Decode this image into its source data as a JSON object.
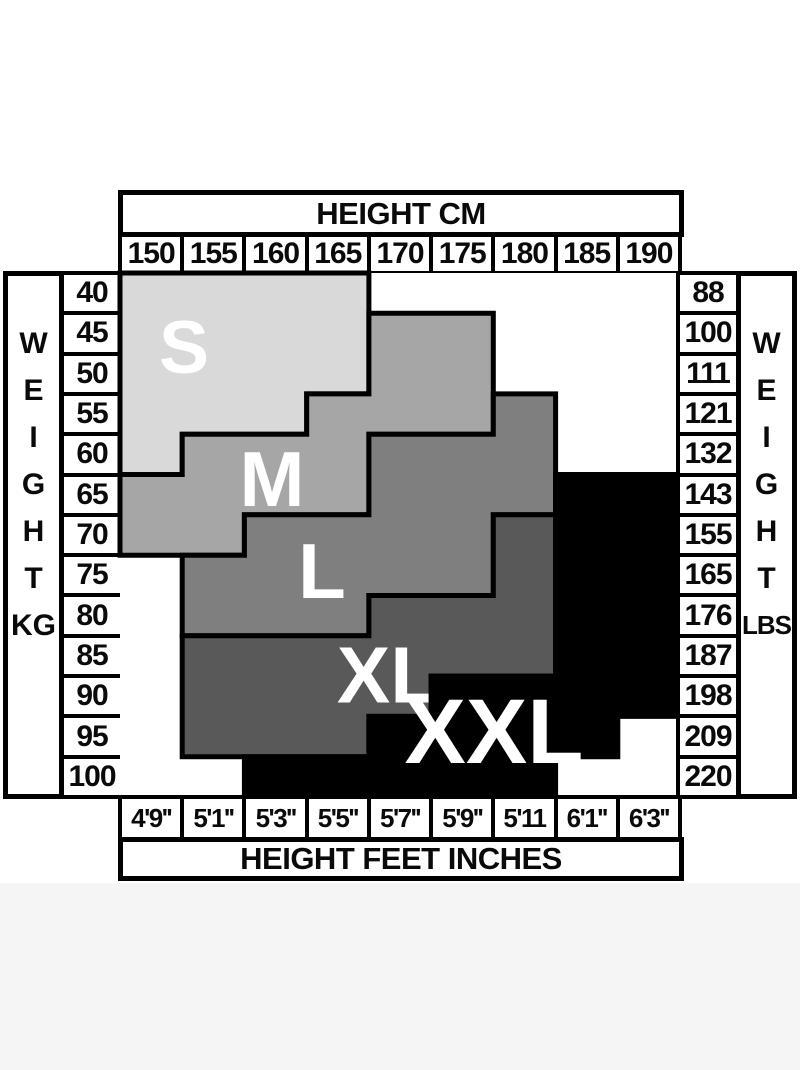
{
  "top_header": {
    "title": "HEIGHT CM"
  },
  "bottom_header": {
    "title": "HEIGHT FEET INCHES"
  },
  "left_axis": {
    "letters": [
      "W",
      "E",
      "I",
      "G",
      "H",
      "T"
    ],
    "unit": "KG"
  },
  "right_axis": {
    "letters": [
      "W",
      "E",
      "I",
      "G",
      "H",
      "T"
    ],
    "unit": "LBS"
  },
  "height_cm_values": [
    "150",
    "155",
    "160",
    "165",
    "170",
    "175",
    "180",
    "185",
    "190"
  ],
  "height_ft_values": [
    "4'9''",
    "5'1''",
    "5'3''",
    "5'5''",
    "5'7''",
    "5'9''",
    "5'11",
    "6'1''",
    "6'3''"
  ],
  "weight_kg_values": [
    "40",
    "45",
    "50",
    "55",
    "60",
    "65",
    "70",
    "75",
    "80",
    "85",
    "90",
    "95",
    "100"
  ],
  "weight_lbs_values": [
    "88",
    "100",
    "111",
    "121",
    "132",
    "143",
    "155",
    "165",
    "176",
    "187",
    "198",
    "209",
    "220"
  ],
  "border_color": "#000000",
  "label_color": "#ffffff",
  "sizes": [
    {
      "label": "S",
      "color": "#d9d9d9",
      "font_size": 75,
      "label_x": 64,
      "label_y": 74,
      "columns": [
        [
          0,
          0,
          4
        ],
        [
          1,
          0,
          3
        ],
        [
          2,
          0,
          3
        ],
        [
          3,
          0,
          2
        ]
      ]
    },
    {
      "label": "M",
      "color": "#a6a6a6",
      "font_size": 78,
      "label_x": 152,
      "label_y": 206,
      "columns": [
        [
          0,
          5,
          6
        ],
        [
          1,
          4,
          6
        ],
        [
          2,
          4,
          5
        ],
        [
          3,
          3,
          5
        ],
        [
          4,
          1,
          3
        ],
        [
          5,
          1,
          3
        ]
      ]
    },
    {
      "label": "L",
      "color": "#7f7f7f",
      "font_size": 78,
      "label_x": 202,
      "label_y": 298,
      "columns": [
        [
          1,
          7,
          8
        ],
        [
          2,
          6,
          8
        ],
        [
          3,
          6,
          8
        ],
        [
          4,
          4,
          7
        ],
        [
          5,
          4,
          7
        ],
        [
          6,
          3,
          5
        ]
      ]
    },
    {
      "label": "XL",
      "color": "#595959",
      "font_size": 80,
      "label_x": 268,
      "label_y": 402,
      "columns": [
        [
          1,
          9,
          11
        ],
        [
          2,
          9,
          11
        ],
        [
          3,
          9,
          11
        ],
        [
          4,
          8,
          10
        ],
        [
          5,
          8,
          9
        ],
        [
          6,
          6,
          9
        ]
      ]
    },
    {
      "label": "XXL",
      "color": "#000000",
      "font_size": 92,
      "label_x": 374,
      "label_y": 459,
      "columns": [
        [
          2,
          12,
          12
        ],
        [
          3,
          12,
          12
        ],
        [
          4,
          11,
          12
        ],
        [
          5,
          10,
          12
        ],
        [
          6,
          10,
          12
        ],
        [
          7,
          5,
          11
        ],
        [
          8,
          5,
          10
        ]
      ]
    }
  ],
  "chart_data": {
    "type": "heatmap",
    "x_top_label": "HEIGHT CM",
    "x_bottom_label": "HEIGHT FEET INCHES",
    "x_ticks_cm": [
      150,
      155,
      160,
      165,
      170,
      175,
      180,
      185,
      190
    ],
    "x_ticks_ft": [
      "4'9''",
      "5'1''",
      "5'3''",
      "5'5''",
      "5'7''",
      "5'9''",
      "5'11",
      "6'1''",
      "6'3''"
    ],
    "y_left_label": "WEIGHT KG",
    "y_right_label": "WEIGHT LBS",
    "y_ticks_kg": [
      40,
      45,
      50,
      55,
      60,
      65,
      70,
      75,
      80,
      85,
      90,
      95,
      100
    ],
    "y_ticks_lbs": [
      88,
      100,
      111,
      121,
      132,
      143,
      155,
      165,
      176,
      187,
      198,
      209,
      220
    ],
    "legend": [
      "S",
      "M",
      "L",
      "XL",
      "XXL"
    ],
    "size_colors": {
      "S": "#d9d9d9",
      "M": "#a6a6a6",
      "L": "#7f7f7f",
      "XL": "#595959",
      "XXL": "#000000"
    },
    "matrix_rows_weight_kg": [
      40,
      45,
      50,
      55,
      60,
      65,
      70,
      75,
      80,
      85,
      90,
      95,
      100
    ],
    "matrix_cols_height_cm": [
      150,
      155,
      160,
      165,
      170,
      175,
      180,
      185,
      190
    ],
    "matrix": [
      [
        "S",
        "S",
        "S",
        "S",
        "",
        "",
        "",
        "",
        ""
      ],
      [
        "S",
        "S",
        "S",
        "S",
        "M",
        "M",
        "",
        "",
        ""
      ],
      [
        "S",
        "S",
        "S",
        "S",
        "M",
        "M",
        "",
        "",
        ""
      ],
      [
        "S",
        "S",
        "S",
        "M",
        "M",
        "M",
        "L",
        "",
        ""
      ],
      [
        "S",
        "M",
        "M",
        "M",
        "L",
        "L",
        "L",
        "",
        ""
      ],
      [
        "M",
        "M",
        "M",
        "M",
        "L",
        "L",
        "L",
        "XXL",
        "XXL"
      ],
      [
        "M",
        "M",
        "L",
        "L",
        "L",
        "L",
        "XL",
        "XXL",
        "XXL"
      ],
      [
        "",
        "L",
        "L",
        "L",
        "L",
        "L",
        "XL",
        "XXL",
        "XXL"
      ],
      [
        "",
        "L",
        "L",
        "L",
        "XL",
        "XL",
        "XL",
        "XXL",
        "XXL"
      ],
      [
        "",
        "XL",
        "XL",
        "XL",
        "XL",
        "XL",
        "XL",
        "XXL",
        "XXL"
      ],
      [
        "",
        "XL",
        "XL",
        "XL",
        "XL",
        "XXL",
        "XXL",
        "XXL",
        "XXL"
      ],
      [
        "",
        "XL",
        "XL",
        "XL",
        "XXL",
        "XXL",
        "XXL",
        "XXL",
        ""
      ],
      [
        "",
        "",
        "XXL",
        "XXL",
        "XXL",
        "XXL",
        "XXL",
        "",
        ""
      ]
    ]
  }
}
